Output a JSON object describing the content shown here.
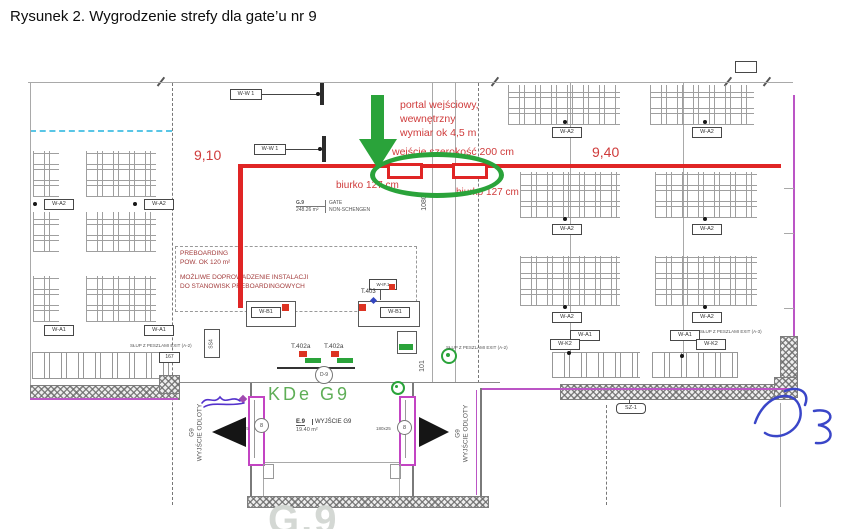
{
  "title": "Rysunek 2. Wygrodzenie strefy dla gate’u nr 9",
  "dimensions": {
    "left": "9,10",
    "right": "9,40",
    "portal_height": "1080",
    "corridor": "101"
  },
  "portal_note": {
    "l1": "portal wejściowy,",
    "l2": "wewnętrzny",
    "l3": "wymiar ok 4,5 m",
    "entry": "wejście szerokość 200 cm",
    "desk_left": "biurko 127 cm",
    "desk_right": "biurko 127 cm"
  },
  "gate_tag": {
    "code": "G.9",
    "name": "GATE",
    "area": "248.26 m²",
    "zone": "NON-SCHENGEN"
  },
  "preboarding": {
    "l1": "PREBOARDING",
    "l2": "POW. OK 120 m²",
    "l3": "MOŻLIWE DOPROWADZENIE INSTALACJI",
    "l4": "DO STANOWISK PREBOARDINGOWYCH"
  },
  "labels": {
    "wa2": "W-A2",
    "wa1": "W-A1",
    "wk2": "W-K2",
    "ww1": "W-W 1",
    "wb1": "W-B1",
    "wif1": "W-IF.1",
    "t403": "T.403",
    "t402a": "T.402a",
    "d9": "D-9",
    "ss4": "SS4",
    "sz1": "SZ-1",
    "box167": "167",
    "door8": "8",
    "size180": "180x25"
  },
  "notes": {
    "slup_a2": "SŁUP Z PESZLAMI EXIT (A-2)",
    "slup_a3": "SŁUP Z PESZLAMI EXIT (A-3)"
  },
  "gate_room": {
    "kde": "KDe G9",
    "exit_code": "E.9",
    "exit_name": "WYJŚCIE G9",
    "exit_area": "19.40 m²",
    "side_g9": "G9",
    "side_exit": "WYJŚCIE ODLOTY",
    "big_text": "G.9"
  },
  "colors": {
    "red": "#e02525",
    "green": "#2aa33a",
    "magenta": "#bb55c5",
    "dashed_blue": "#59c6e6",
    "pen_blue": "#3a46c8"
  }
}
